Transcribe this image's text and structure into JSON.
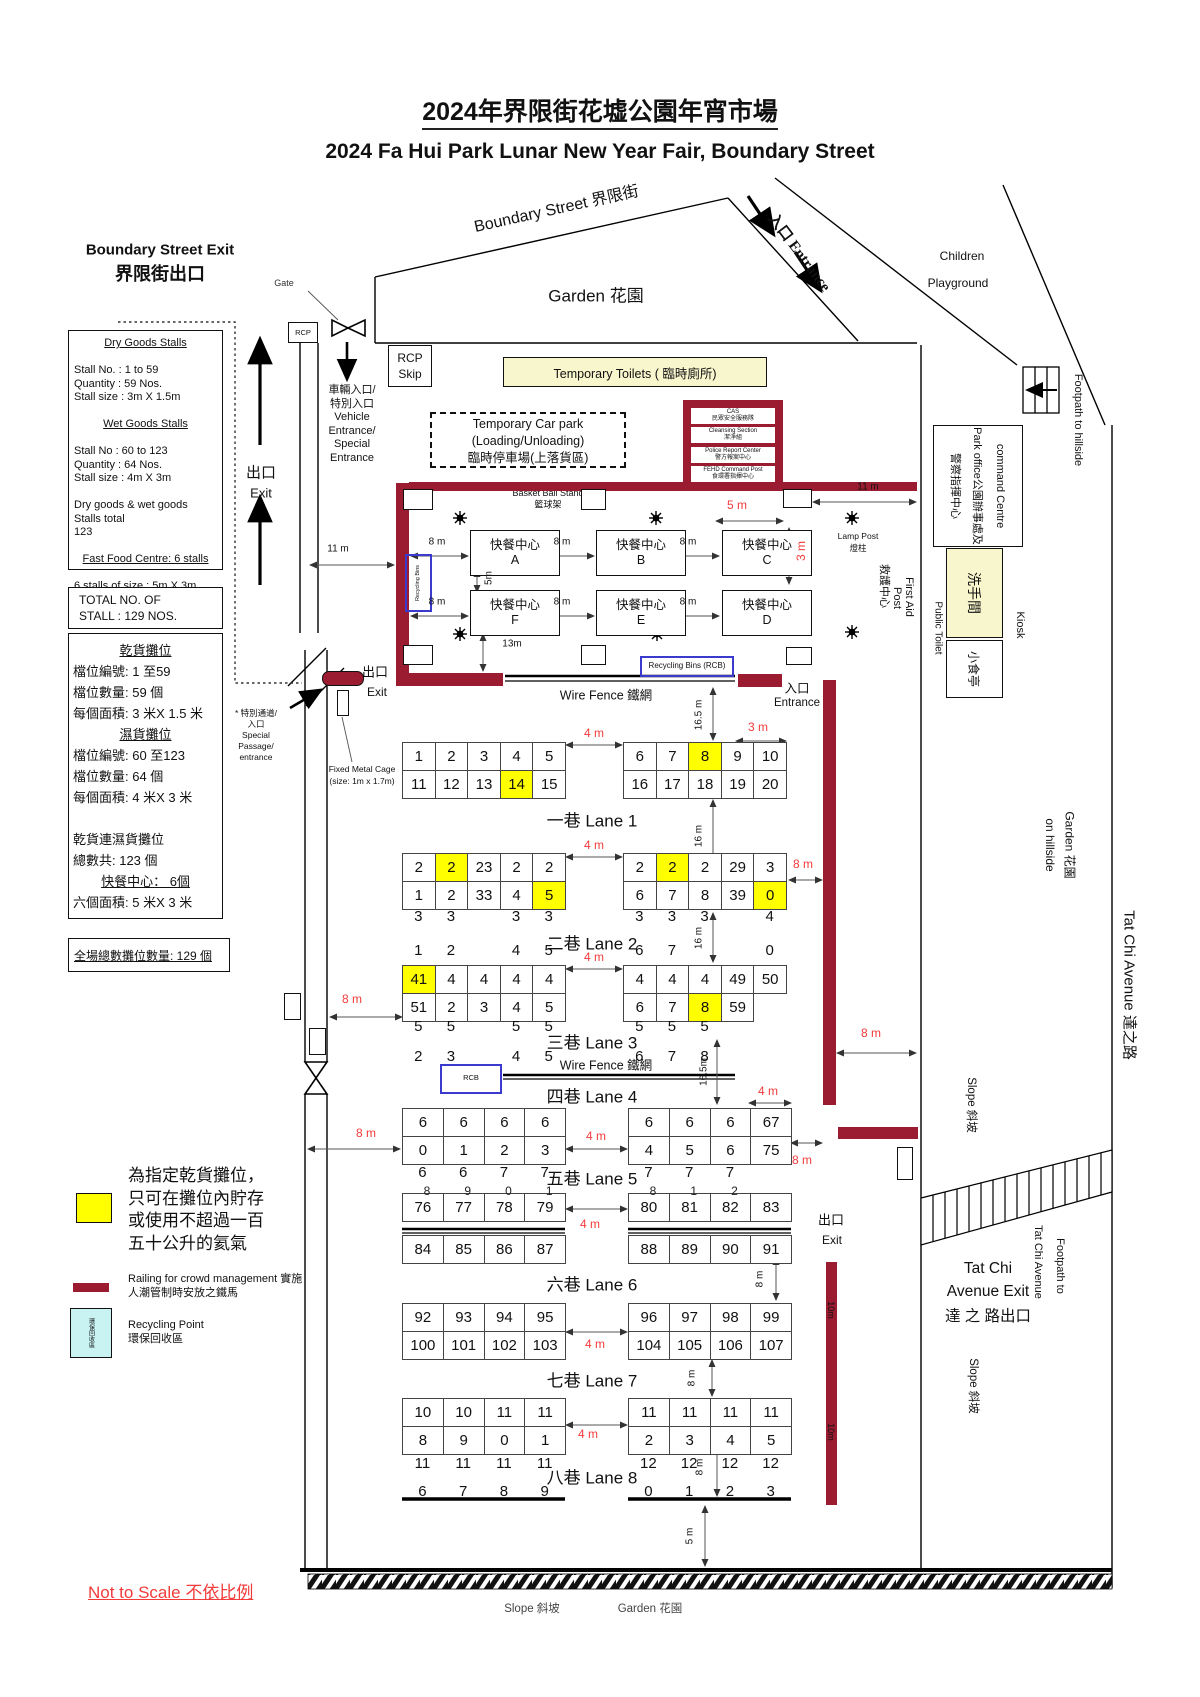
{
  "title": {
    "zh": "2024年界限街花墟公園年宵市場",
    "en": "2024 Fa Hui Park Lunar New Year Fair, Boundary Street"
  },
  "boundary_exit": {
    "en": "Boundary Street Exit",
    "zh": "界限街出口"
  },
  "info_box": {
    "lines": [
      {
        "t": "Dry Goods Stalls",
        "c": 1,
        "u": 1
      },
      {
        "t": ""
      },
      {
        "t": "Stall   No.    : 1 to 59"
      },
      {
        "t": "Quantity      : 59 Nos."
      },
      {
        "t": "Stall size : 3m X 1.5m"
      },
      {
        "t": ""
      },
      {
        "t": "Wet Goods Stalls",
        "c": 1,
        "u": 1
      },
      {
        "t": ""
      },
      {
        "t": "Stall No : 60 to 123"
      },
      {
        "t": "Quantity : 64 Nos."
      },
      {
        "t": "Stall size : 4m X 3m"
      },
      {
        "t": ""
      },
      {
        "t": "Dry goods & wet goods Stalls total"
      },
      {
        "t": "123"
      },
      {
        "t": ""
      },
      {
        "t": "Fast Food Centre: 6 stalls",
        "c": 1,
        "u": 1
      },
      {
        "t": ""
      },
      {
        "t": "6 stalls of size : 5m X 3m"
      }
    ]
  },
  "total_box": [
    "TOTAL NO. OF",
    "STALL : 129 NOS."
  ],
  "zh_box": {
    "lines": [
      {
        "t": "乾貨攤位",
        "c": 1,
        "u": 1
      },
      {
        "t": "檔位編號:  1 至59"
      },
      {
        "t": "檔位數量:  59 個"
      },
      {
        "t": "每個面積:  3 米X 1.5 米"
      },
      {
        "t": "濕貨攤位",
        "c": 1,
        "u": 1
      },
      {
        "t": "檔位編號:  60 至123"
      },
      {
        "t": "檔位數量:  64 個"
      },
      {
        "t": "每個面積:  4 米X 3 米"
      },
      {
        "t": ""
      },
      {
        "t": "乾貨連濕貨攤位"
      },
      {
        "t": "總數共:  123 個"
      },
      {
        "t": "快餐中心：  6個",
        "c": 1,
        "u": 1
      },
      {
        "t": "六個面積:  5 米X 3 米"
      }
    ]
  },
  "grand_total": "全場總數攤位數量: 129 個",
  "legend": {
    "gas_lines": [
      "為指定乾貨攤位，",
      "只可在攤位內貯存",
      "或使用不超過一百",
      "五十公升的氦氣"
    ],
    "railing_lines": [
      "Railing for crowd management 實施",
      "人潮管制時安放之鐵馬"
    ],
    "recycling_lines": [
      "Recycling Point",
      "環保回收區"
    ],
    "recycling_box": "環保回收區"
  },
  "not_to_scale": "Not to Scale 不依比例",
  "top": {
    "gate": "Gate",
    "rcp": "RCP",
    "rcp_skip": [
      "RCP",
      "Skip"
    ],
    "exit_zh": "出口",
    "exit_en": "Exit",
    "vehicle_lines": [
      "車輛入口/",
      "特別入口",
      "Vehicle",
      "Entrance/",
      "Special",
      "Entrance"
    ],
    "toilets": "Temporary Toilets ( 臨時廁所)",
    "carpark_lines": [
      "Temporary Car park",
      "(Loading/Unloading)",
      "臨時停車場(上落貨區)"
    ],
    "boundary_street": "Boundary Street 界限街",
    "garden": "Garden  花園",
    "entrance": "入口 Entrance",
    "children": [
      "Children",
      "Playground"
    ],
    "basketball": [
      "Basket Ball Stand",
      "籃球架"
    ]
  },
  "command_post": {
    "rows": [
      [
        "CAS",
        "民眾安全服務隊"
      ],
      [
        "Cleansing Section",
        "潔淨組"
      ],
      [
        "Police Report Center",
        "警方報案中心"
      ],
      [
        "FEHD Command Post",
        "食環署指揮中心"
      ]
    ]
  },
  "right_side": {
    "command_centre_lines": [
      "command Centre",
      "Park office公園辦事處及",
      "警察指揮中心"
    ],
    "washroom": "洗手間",
    "public_toilet": "Public Toilet",
    "kiosk_box": "小食亭",
    "kiosk": "Kiosk",
    "first_aid": [
      "First Aid",
      "Post",
      "救護中心"
    ],
    "footpath_hillside": "Footpath to hillside",
    "garden_hillside": [
      "Garden  花園",
      "on hillside"
    ],
    "tat_chi_avenue": "Tat Chi Avenue  達之路",
    "slope": "Slope 斜坡",
    "footpath_ttc": [
      "Footpath to",
      "Tat Chi Avenue"
    ],
    "tat_chi_exit_lines": [
      "Tat Chi",
      "Avenue Exit",
      "達 之 路出口"
    ],
    "ten_m": "10m"
  },
  "food_court": {
    "name": "快餐中心",
    "units": [
      "A",
      "B",
      "C",
      "F",
      "E",
      "D"
    ],
    "lamp_post": [
      "Lamp Post",
      "燈柱"
    ],
    "recycling_bins_vert": "Recycling Bins"
  },
  "mid": {
    "exit_zh": "出口",
    "exit_en": "Exit",
    "entrance_zh": "入口",
    "entrance_en": "Entrance",
    "wire_fence": "Wire Fence  鐵網",
    "rcb_long": "Recycling Bins (RCB)",
    "rcb_short": "RCB",
    "fixed_cage": [
      "Fixed Metal Cage",
      "(size: 1m x 1.7m)"
    ],
    "special_passage": [
      "* 特別通道/",
      "入口",
      "Special",
      "Passage/",
      "entrance"
    ],
    "exit_right_zh": "出口",
    "exit_right_en": "Exit"
  },
  "bottom": {
    "slope": "Slope 斜坡",
    "garden": "Garden  花園"
  },
  "lanes": [
    {
      "zh": "一巷",
      "en": "Lane 1",
      "left": [
        [
          "1",
          "2",
          "3",
          "4",
          "5"
        ],
        [
          "11",
          "12",
          "13",
          {
            "t": "14",
            "y": 1
          },
          "15"
        ]
      ],
      "right": [
        [
          "6",
          "7",
          {
            "t": "8",
            "y": 1
          },
          "9",
          "10"
        ],
        [
          "16",
          "17",
          "18",
          "19",
          "20"
        ]
      ]
    },
    {
      "zh": "二巷",
      "en": "Lane 2",
      "left": [
        [
          "2",
          {
            "t": "2",
            "y": 1
          },
          "23",
          "2",
          "2"
        ],
        [
          "1",
          "2",
          "33",
          "4",
          {
            "t": "5",
            "y": 1
          }
        ]
      ],
      "right": [
        [
          "2",
          {
            "t": "2",
            "y": 1
          },
          "2",
          "29",
          "3"
        ],
        [
          "6",
          "7",
          "8",
          "39",
          {
            "t": "0",
            "y": 1
          }
        ]
      ],
      "strayA": {
        "left": [
          "3",
          "3",
          "",
          "3",
          "3"
        ],
        "right": [
          "3",
          "3",
          "3",
          "",
          "4"
        ]
      },
      "strayB": {
        "left": [
          "1",
          "2",
          "",
          "4",
          "5"
        ],
        "right": [
          "6",
          "7",
          "",
          "",
          "0"
        ]
      }
    },
    {
      "zh": "三巷",
      "en": "Lane 3",
      "left": [
        [
          {
            "t": "41",
            "y": 1
          },
          "4",
          "4",
          "4",
          "4"
        ],
        [
          "51",
          "2",
          "3",
          "4",
          "5"
        ]
      ],
      "right": [
        [
          "4",
          "4",
          "4",
          "49",
          "50"
        ],
        [
          "6",
          "7",
          {
            "t": "8",
            "y": 1
          },
          "59"
        ]
      ],
      "strayA": {
        "left": [
          "5",
          "5",
          "",
          "5",
          "5"
        ],
        "right": [
          "5",
          "5",
          "5",
          "",
          ""
        ]
      },
      "strayB": {
        "left": [
          "2",
          "3",
          "",
          "4",
          "5"
        ],
        "right": [
          "6",
          "7",
          "8",
          "",
          ""
        ]
      }
    },
    {
      "zh": "四巷",
      "en": "Lane 4",
      "left": [
        [
          "6",
          "6",
          "6",
          "6"
        ],
        [
          "0",
          "1",
          "2",
          "3"
        ]
      ],
      "right": [
        [
          "6",
          "6",
          "6",
          "67"
        ],
        [
          "4",
          "5",
          "6",
          "75"
        ]
      ],
      "strayA": {
        "left": [
          "6",
          "6",
          "7",
          "7"
        ],
        "right": [
          "7",
          "7",
          "7",
          ""
        ]
      }
    },
    {
      "zh": "五巷",
      "en": "Lane 5",
      "left": [
        [
          {
            "t": "76",
            "o": "8"
          },
          {
            "t": "77",
            "o": "9"
          },
          {
            "t": "78",
            "o": "0"
          },
          {
            "t": "79",
            "o": "1"
          }
        ],
        [
          "84",
          "85",
          "86",
          "87"
        ]
      ],
      "right": [
        [
          {
            "t": "80",
            "o": "8"
          },
          {
            "t": "81",
            "o": "1"
          },
          {
            "t": "82",
            "o": "2"
          },
          "83"
        ],
        [
          "88",
          "89",
          "90",
          "91"
        ]
      ]
    },
    {
      "zh": "六巷",
      "en": "Lane 6",
      "left": [
        [
          "92",
          "93",
          "94",
          "95"
        ],
        [
          "100",
          "101",
          "102",
          "103"
        ]
      ],
      "right": [
        [
          "96",
          "97",
          "98",
          "99"
        ],
        [
          "104",
          "105",
          "106",
          "107"
        ]
      ]
    },
    {
      "zh": "七巷",
      "en": "Lane 7",
      "left": [
        [
          "10",
          "10",
          "11",
          "11"
        ],
        [
          "8",
          "9",
          "0",
          "1"
        ]
      ],
      "right": [
        [
          "11",
          "11",
          "11",
          "11"
        ],
        [
          "2",
          "3",
          "4",
          "5"
        ]
      ],
      "strayA": {
        "left": [
          "11",
          "11",
          "11",
          "11"
        ],
        "right": [
          "12",
          "12",
          "12",
          "12"
        ]
      },
      "strayB": {
        "left": [
          "6",
          "7",
          "8",
          "9"
        ],
        "right": [
          "0",
          "1",
          "2",
          "3"
        ]
      }
    },
    {
      "zh": "八巷",
      "en": "Lane 8"
    }
  ],
  "measures": [
    {
      "t": "4 m",
      "r": 1,
      "c": [
        594,
        733
      ],
      "line": [
        566,
        745,
        622,
        745
      ]
    },
    {
      "t": "4 m",
      "r": 1,
      "c": [
        594,
        845
      ],
      "line": [
        566,
        857,
        622,
        857
      ]
    },
    {
      "t": "4 m",
      "r": 1,
      "c": [
        594,
        957
      ],
      "line": [
        566,
        969,
        622,
        969
      ]
    },
    {
      "t": "4 m",
      "r": 1,
      "c": [
        596,
        1136
      ],
      "line": [
        566,
        1149,
        627,
        1149
      ]
    },
    {
      "t": "4 m",
      "r": 1,
      "c": [
        590,
        1224
      ],
      "line": [
        566,
        1209,
        627,
        1209
      ]
    },
    {
      "t": "4 m",
      "r": 1,
      "c": [
        595,
        1344
      ],
      "line": [
        566,
        1332,
        627,
        1332
      ]
    },
    {
      "t": "4 m",
      "r": 1,
      "c": [
        588,
        1434
      ],
      "line": [
        566,
        1425,
        627,
        1425
      ]
    },
    {
      "t": "4 m",
      "r": 1,
      "c": [
        768,
        1091
      ],
      "line": [
        749,
        1103,
        791,
        1103
      ]
    },
    {
      "t": "3 m",
      "r": 1,
      "c": [
        758,
        727
      ],
      "line": [
        736,
        741,
        786,
        741
      ]
    },
    {
      "t": "8 m",
      "r": 1,
      "c": [
        352,
        999
      ],
      "line": [
        330,
        1017,
        402,
        1017
      ]
    },
    {
      "t": "8 m",
      "r": 1,
      "c": [
        366,
        1133
      ],
      "line": [
        308,
        1149,
        400,
        1149
      ]
    },
    {
      "t": "8 m",
      "r": 1,
      "c": [
        803,
        864
      ],
      "line": [
        789,
        880,
        822,
        880
      ]
    },
    {
      "t": "8 m",
      "r": 1,
      "c": [
        802,
        1160
      ],
      "line": [
        791,
        1143,
        822,
        1143
      ]
    },
    {
      "t": "8 m",
      "r": 1,
      "c": [
        871,
        1033
      ],
      "line": [
        837,
        1053,
        916,
        1053
      ]
    },
    {
      "t": "5 m",
      "r": 1,
      "c": [
        737,
        505
      ],
      "line": [
        716,
        521,
        783,
        521
      ]
    },
    {
      "t": "3 m",
      "r": 1,
      "v": 1,
      "c": [
        801,
        551
      ],
      "line": [
        789,
        528,
        789,
        584
      ]
    },
    {
      "t": "8 m",
      "c": [
        437,
        542
      ],
      "line": [
        411,
        556,
        468,
        556
      ]
    },
    {
      "t": "8 m",
      "c": [
        562,
        542
      ],
      "line": [
        533,
        556,
        594,
        556
      ]
    },
    {
      "t": "8 m",
      "c": [
        688,
        542
      ],
      "line": [
        659,
        556,
        719,
        556
      ]
    },
    {
      "t": "8 m",
      "c": [
        437,
        602
      ],
      "line": [
        411,
        616,
        468,
        616
      ]
    },
    {
      "t": "8 m",
      "c": [
        562,
        602
      ],
      "line": [
        533,
        616,
        594,
        616
      ]
    },
    {
      "t": "8 m",
      "c": [
        688,
        602
      ],
      "line": [
        659,
        616,
        719,
        616
      ]
    },
    {
      "t": "5m",
      "v": 1,
      "c": [
        489,
        578
      ],
      "line": [
        477,
        570,
        477,
        592
      ]
    },
    {
      "t": "13m",
      "c": [
        512,
        644
      ],
      "line": [
        483,
        634,
        483,
        671
      ]
    },
    {
      "t": "11 m",
      "c": [
        338,
        549
      ],
      "line": [
        310,
        565,
        394,
        565
      ]
    },
    {
      "t": "11 m",
      "c": [
        868,
        487
      ],
      "line": [
        813,
        502,
        916,
        502
      ]
    },
    {
      "t": "16.5 m",
      "v": 1,
      "c": [
        699,
        715
      ],
      "line": [
        713,
        688,
        713,
        740
      ]
    },
    {
      "t": "16 m",
      "v": 1,
      "c": [
        699,
        836
      ],
      "line": [
        713,
        800,
        713,
        873
      ]
    },
    {
      "t": "16 m",
      "v": 1,
      "c": [
        699,
        938
      ],
      "line": [
        713,
        913,
        713,
        962
      ]
    },
    {
      "t": "16.5m",
      "v": 1,
      "c": [
        704,
        1072
      ],
      "line": [
        717,
        1040,
        717,
        1104
      ]
    },
    {
      "t": "8 m",
      "v": 1,
      "c": [
        760,
        1279
      ],
      "line": [
        776,
        1258,
        776,
        1300
      ]
    },
    {
      "t": "8 m",
      "v": 1,
      "c": [
        692,
        1378
      ],
      "line": [
        712,
        1360,
        712,
        1396
      ]
    },
    {
      "t": "8 m",
      "v": 1,
      "c": [
        700,
        1467
      ],
      "line": [
        717,
        1438,
        717,
        1496
      ]
    },
    {
      "t": "5 m",
      "v": 1,
      "c": [
        690,
        1536
      ],
      "line": [
        705,
        1506,
        705,
        1566
      ]
    }
  ]
}
